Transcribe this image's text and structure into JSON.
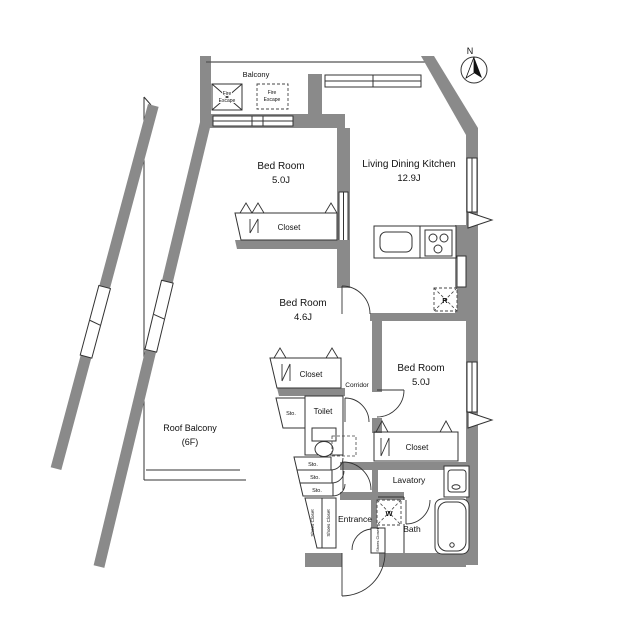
{
  "title": "Apartment floor plan",
  "colors": {
    "wall": "#8a8a8a",
    "line": "#333333",
    "text": "#111111",
    "background": "#ffffff"
  },
  "compass": {
    "north_label": "N"
  },
  "balcony": {
    "label": "Balcony"
  },
  "fire_escape_left": {
    "line1": "Fire",
    "line2": "Escape"
  },
  "fire_escape_right": {
    "line1": "Fire",
    "line2": "Escape"
  },
  "rooms": {
    "bedroom_top": {
      "name": "Bed Room",
      "size": "5.0J"
    },
    "ldk": {
      "name": "Living Dining Kitchen",
      "size": "12.9J"
    },
    "bedroom_middle": {
      "name": "Bed Room",
      "size": "4.6J"
    },
    "bedroom_right": {
      "name": "Bed Room",
      "size": "5.0J"
    },
    "roof_balcony": {
      "name": "Roof Balcony",
      "floor": "(6F)"
    },
    "corridor": {
      "label": "Corridor"
    },
    "toilet": {
      "label": "Toilet"
    },
    "lavatory": {
      "label": "Lavatory"
    },
    "bath": {
      "label": "Bath"
    },
    "entrance": {
      "label": "Entrance"
    }
  },
  "storage": {
    "closet_top": "Closet",
    "closet_middle": "Closet",
    "closet_right": "Closet",
    "sto_beside_toilet": "Sto.",
    "sto_1": "Sto.",
    "sto_2": "Sto.",
    "sto_3": "Sto.",
    "shoes_closet": "Shoes Closet"
  },
  "appliances": {
    "refrigerator": "R",
    "washer": "W"
  }
}
